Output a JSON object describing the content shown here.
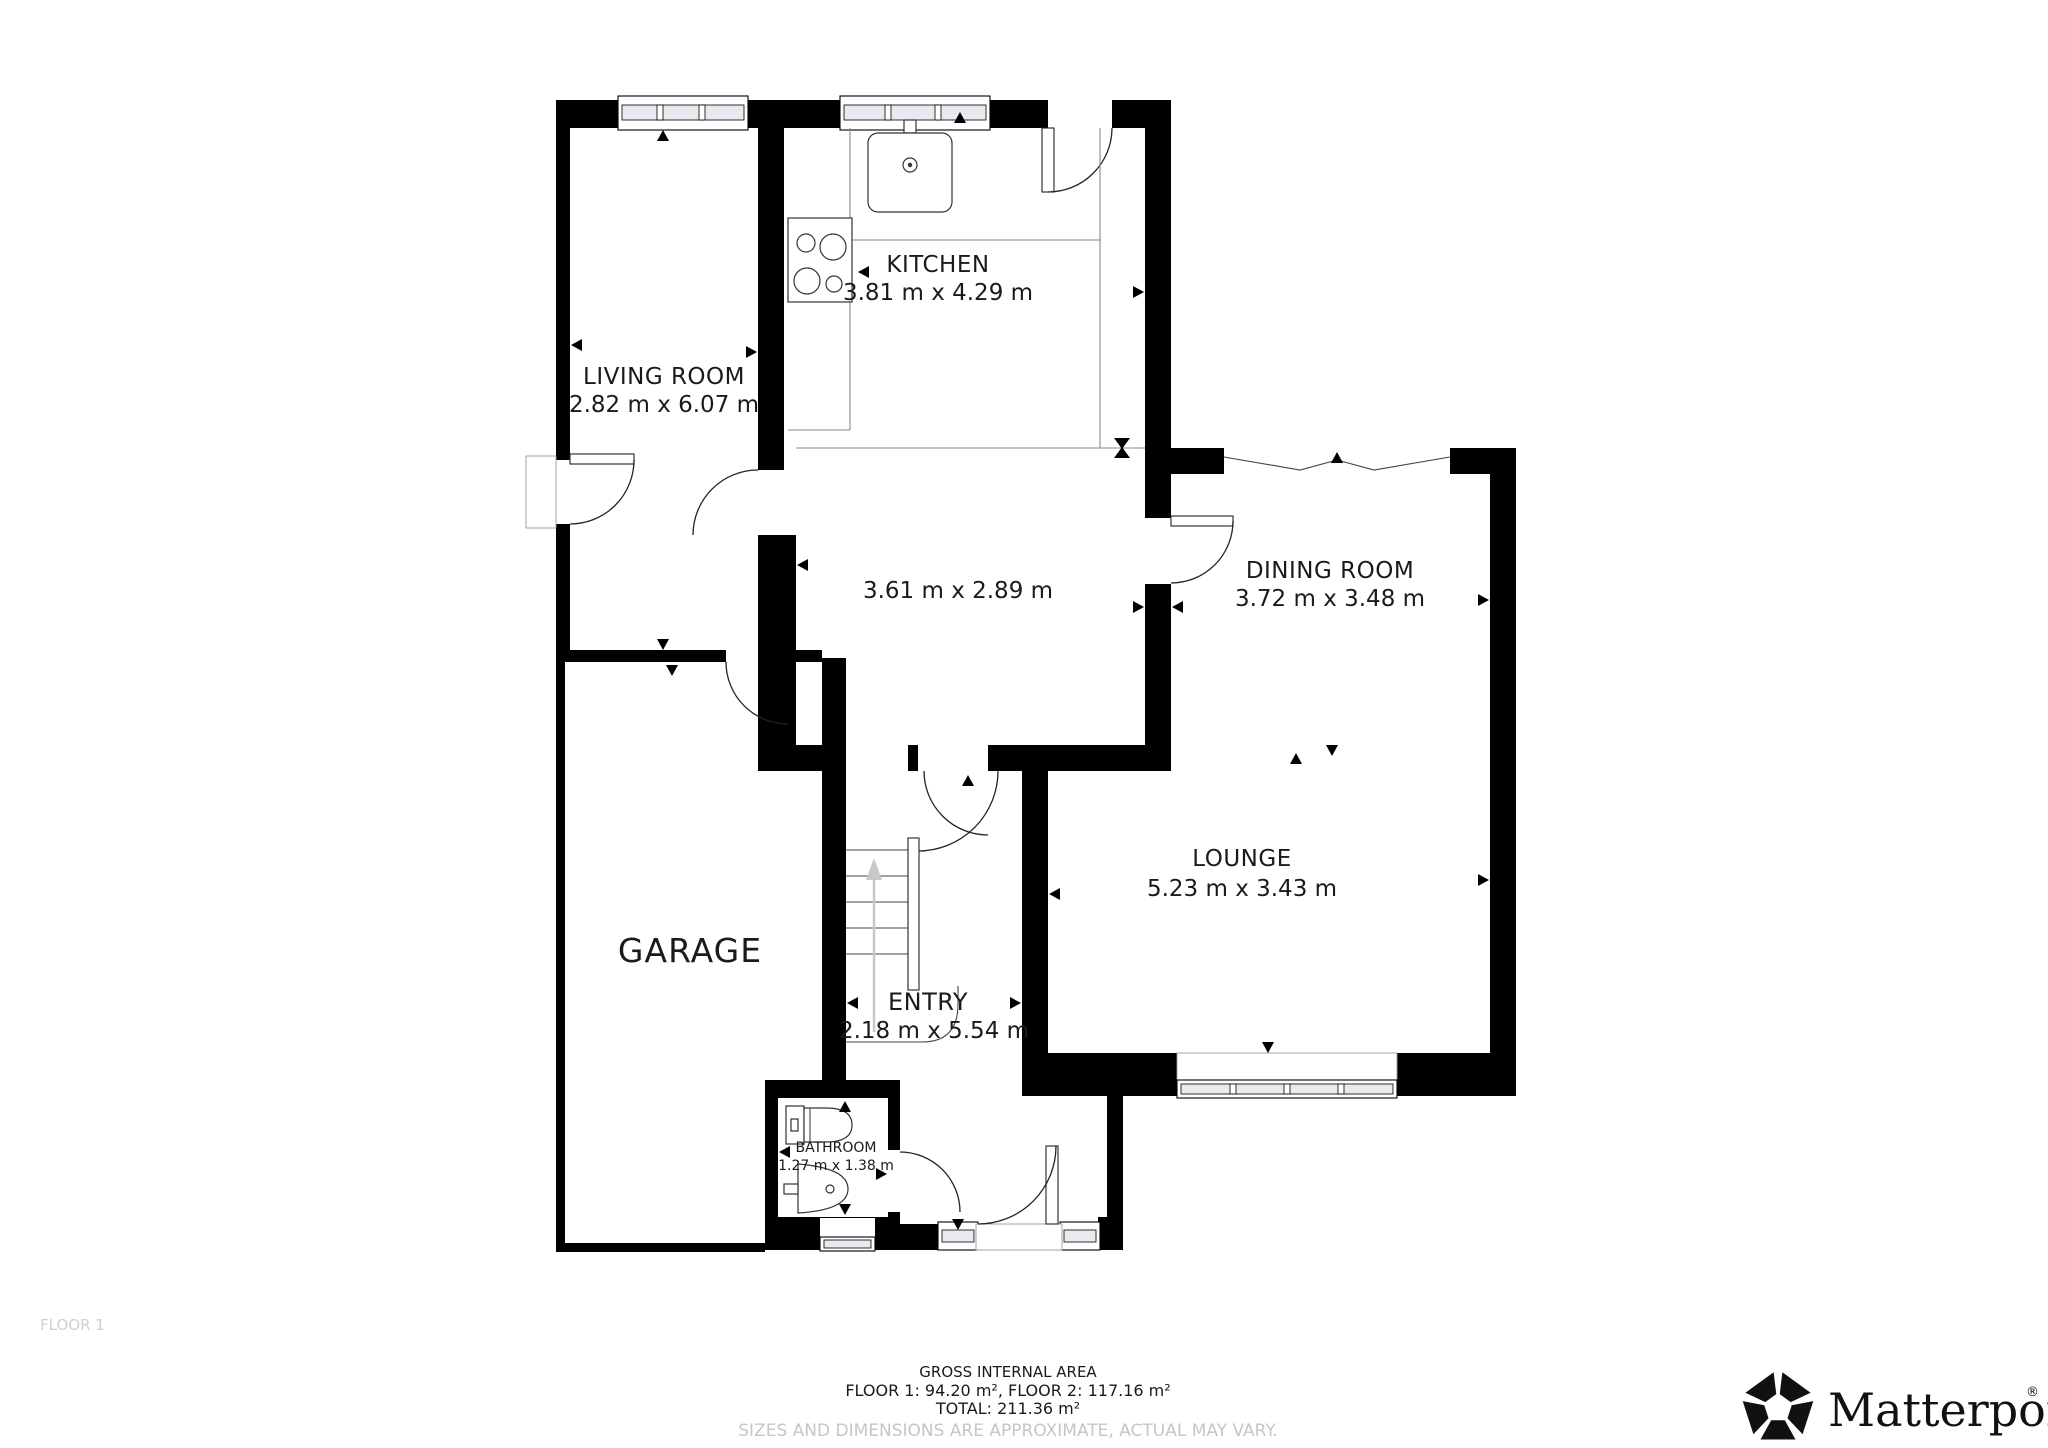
{
  "plan": {
    "floor_label": "FLOOR 1",
    "rooms": {
      "kitchen": {
        "name": "KITCHEN",
        "dims": "3.81 m x 4.29 m"
      },
      "living_room": {
        "name": "LIVING ROOM",
        "dims": "2.82 m x 6.07 m"
      },
      "hallway": {
        "dims": "3.61 m x 2.89 m"
      },
      "dining_room": {
        "name": "DINING ROOM",
        "dims": "3.72 m x 3.48 m"
      },
      "lounge": {
        "name": "LOUNGE",
        "dims": "5.23 m x 3.43 m"
      },
      "garage": {
        "name": "GARAGE"
      },
      "entry": {
        "name": "ENTRY",
        "dims": "2.18 m x 5.54 m"
      },
      "bathroom": {
        "name": "BATHROOM",
        "dims": "1.27 m x 1.38 m"
      }
    }
  },
  "footer": {
    "area_title": "GROSS INTERNAL AREA",
    "area_line1": "FLOOR 1: 94.20 m², FLOOR 2: 117.16 m²",
    "area_line2": "TOTAL: 211.36 m²",
    "disclaimer": "SIZES AND DIMENSIONS ARE APPROXIMATE, ACTUAL MAY VARY.",
    "brand": "Matterport",
    "brand_mark": "®"
  },
  "colors": {
    "walls": "#000000",
    "background": "#ffffff",
    "muted_text": "#c6c6c6",
    "window_pane": "#e8eaf0",
    "stair_arrow": "#c8c8c8"
  }
}
